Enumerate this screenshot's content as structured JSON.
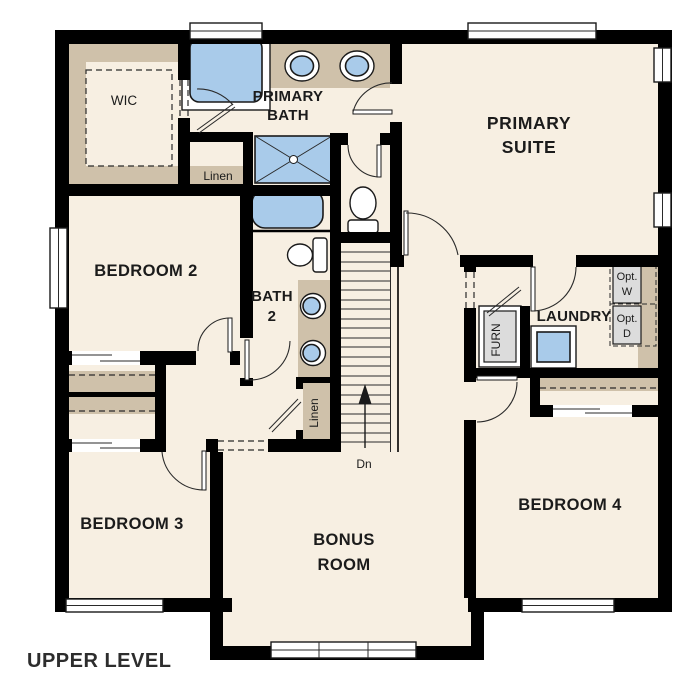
{
  "title": "UPPER LEVEL",
  "colors": {
    "background": "#ffffff",
    "floor": "#f7efe2",
    "wall": "#000000",
    "shelf": "#cfc1aa",
    "fixture": "#a9cbea",
    "appliance": "#dcdcdc"
  },
  "rooms": {
    "wic": {
      "label": "WIC"
    },
    "primary_bath": {
      "line1": "PRIMARY",
      "line2": "BATH"
    },
    "primary_suite": {
      "line1": "PRIMARY",
      "line2": "SUITE"
    },
    "bedroom2": {
      "label": "BEDROOM 2"
    },
    "bath2": {
      "line1": "BATH",
      "line2": "2"
    },
    "laundry": {
      "label": "LAUNDRY"
    },
    "bedroom3": {
      "label": "BEDROOM 3"
    },
    "bonus": {
      "line1": "BONUS",
      "line2": "ROOM"
    },
    "bedroom4": {
      "label": "BEDROOM 4"
    }
  },
  "closets": {
    "linen_bath": {
      "label": "Linen"
    },
    "linen_hall": {
      "label": "Linen"
    }
  },
  "equipment": {
    "furnace": {
      "label": "FURN"
    },
    "opt_washer": {
      "line1": "Opt.",
      "line2": "W"
    },
    "opt_dryer": {
      "line1": "Opt.",
      "line2": "D"
    }
  },
  "stairs": {
    "direction_label": "Dn"
  }
}
